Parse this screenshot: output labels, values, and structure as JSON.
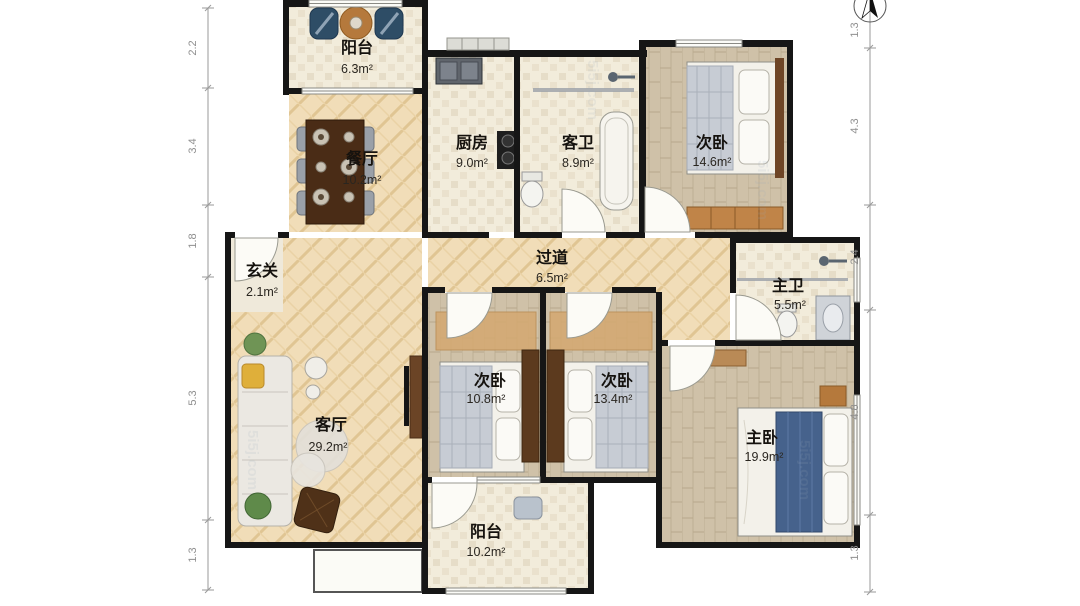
{
  "page_title": "apartment-floor-plan",
  "watermark": "5i5j.com",
  "rooms": {
    "balcony_top": {
      "name": "阳台",
      "area": "6.3m²"
    },
    "dining": {
      "name": "餐厅",
      "area": "10.2m²"
    },
    "kitchen": {
      "name": "厨房",
      "area": "9.0m²"
    },
    "guest_bath": {
      "name": "客卫",
      "area": "8.9m²"
    },
    "bedroom_ne": {
      "name": "次卧",
      "area": "14.6m²"
    },
    "entry": {
      "name": "玄关",
      "area": "2.1m²"
    },
    "corridor": {
      "name": "过道",
      "area": "6.5m²"
    },
    "master_bath": {
      "name": "主卫",
      "area": "5.5m²"
    },
    "living": {
      "name": "客厅",
      "area": "29.2m²"
    },
    "bedroom_mid_left": {
      "name": "次卧",
      "area": "10.8m²"
    },
    "bedroom_mid_right": {
      "name": "次卧",
      "area": "13.4m²"
    },
    "master_bedroom": {
      "name": "主卧",
      "area": "19.9m²"
    },
    "balcony_bottom": {
      "name": "阳台",
      "area": "10.2m²"
    }
  },
  "dimensions": {
    "left": [
      "2.2",
      "3.4",
      "1.8",
      "5.3",
      "1.3"
    ],
    "right": [
      "1.3",
      "4.3",
      "2.4",
      "4.8",
      "1.3"
    ]
  },
  "colors": {
    "wall": "#161616",
    "floor_herringbone": "#f1ddb8",
    "floor_tile": "#f2ecdb",
    "floor_wood": "#cfc1a8",
    "bed_accent": "#46628c",
    "wardrobe": "#c08448"
  }
}
